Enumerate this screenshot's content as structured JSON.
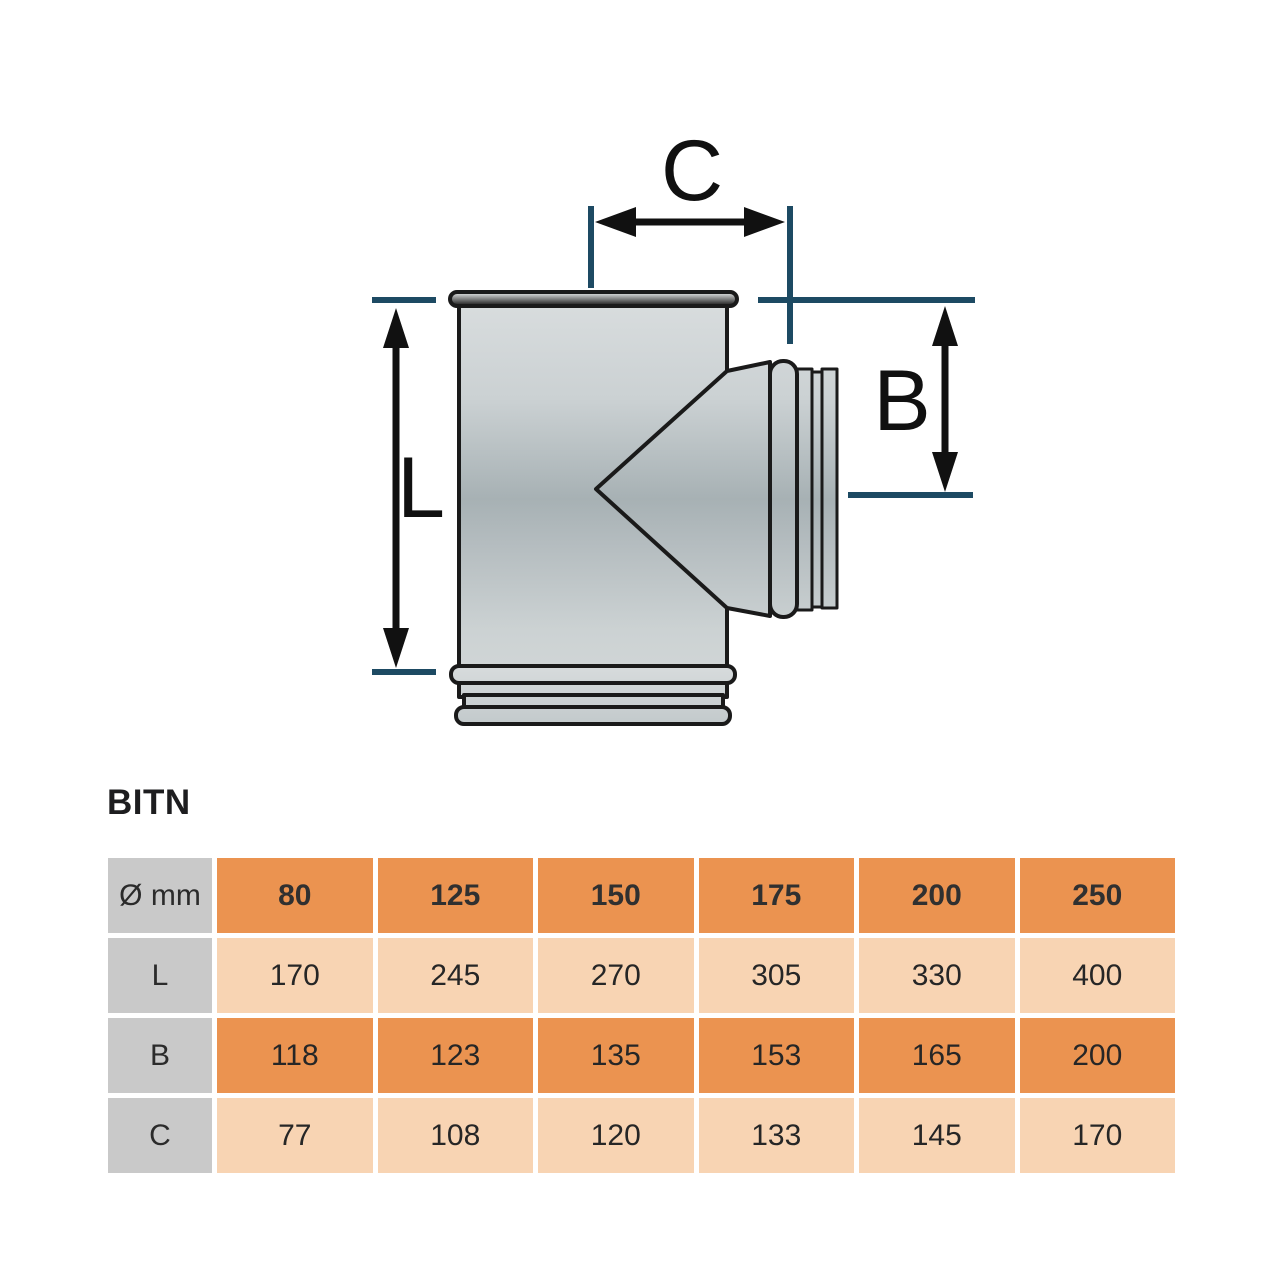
{
  "product": {
    "title": "BITN"
  },
  "diagram": {
    "c_label": "C",
    "b_label": "B",
    "l_label": "L",
    "colors": {
      "reference_line": "#1d4a63",
      "arrow": "#111111",
      "outline": "#1a1a1a",
      "body_gray": "#c4cbcd"
    }
  },
  "table": {
    "corner": "Ø mm",
    "headers": [
      "80",
      "125",
      "150",
      "175",
      "200",
      "250"
    ],
    "rows": [
      {
        "label": "L",
        "values": [
          "170",
          "245",
          "270",
          "305",
          "330",
          "400"
        ]
      },
      {
        "label": "B",
        "values": [
          "118",
          "123",
          "135",
          "153",
          "165",
          "200"
        ]
      },
      {
        "label": "C",
        "values": [
          "77",
          "108",
          "120",
          "133",
          "145",
          "170"
        ]
      }
    ],
    "colors": {
      "header_bg": "#eb9350",
      "row_dark_bg": "#eb9350",
      "row_light_bg": "#f8d4b3",
      "label_bg": "#c9c9c9"
    }
  }
}
